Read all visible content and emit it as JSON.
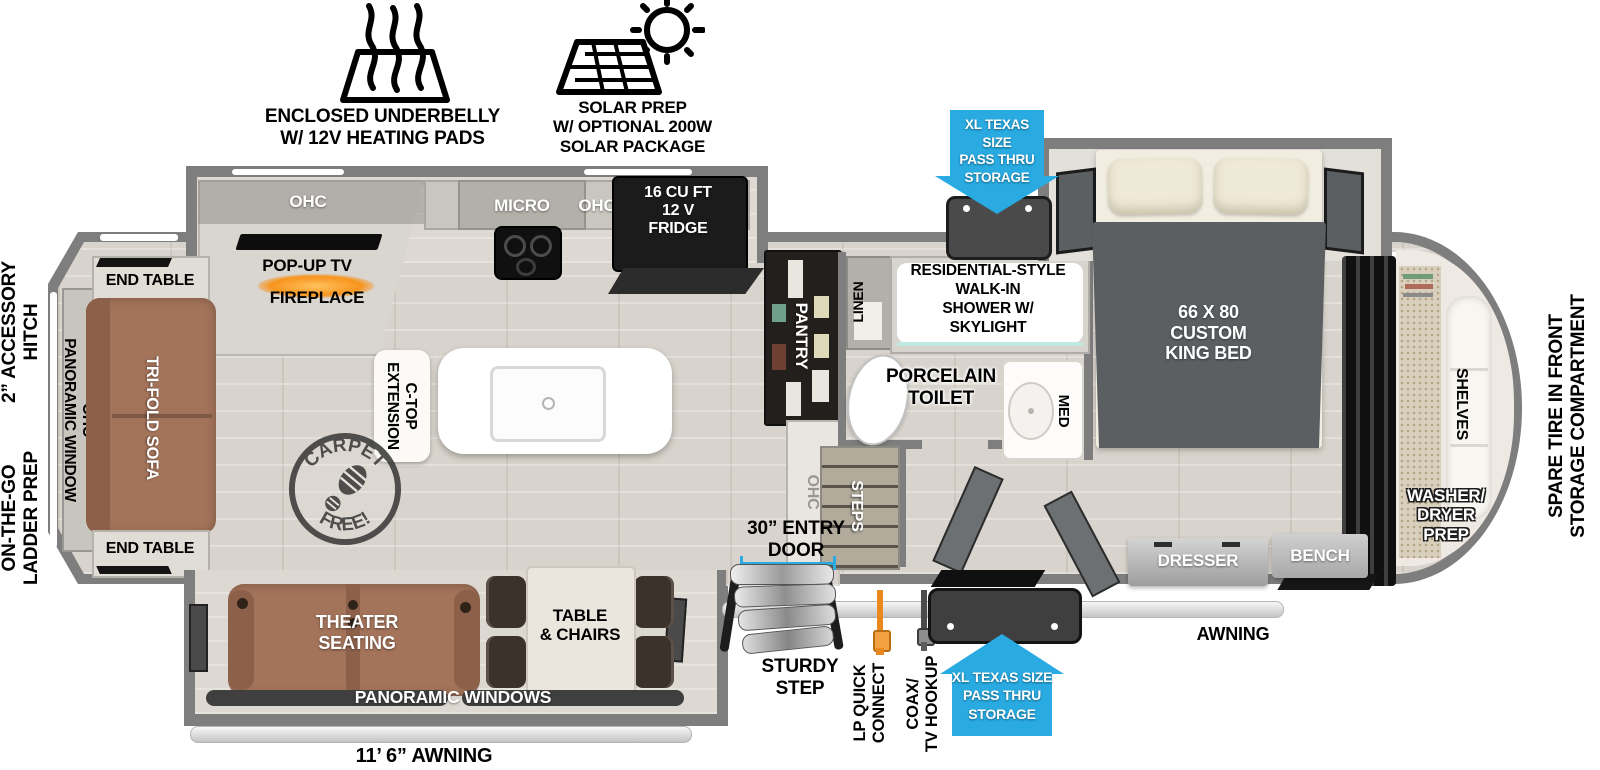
{
  "title": "Fifth-wheel RV floorplan",
  "colors": {
    "accent_blue": "#29ABE2",
    "lp_orange": "#E8881E",
    "fireplace_orange": "#F7941E",
    "sofa_brown": "#A3735A",
    "wall_gray": "#7E7E7E",
    "cabinet_black": "#1B1B1B"
  },
  "features": {
    "underbelly_label": "ENCLOSED UNDERBELLY\nW/ 12V HEATING PADS",
    "solar_label": "SOLAR PREP\nW/ OPTIONAL 200W\nSOLAR PACKAGE"
  },
  "storage": {
    "pass_thru_top": "XL TEXAS SIZE\nPASS THRU\nSTORAGE",
    "pass_thru_bottom": "XL TEXAS SIZE\nPASS THRU\nSTORAGE"
  },
  "exterior": {
    "hitch": "2” ACCESSORY\nHITCH",
    "ladder_prep": "ON-THE-GO\nLADDER PREP",
    "spare_tire": "SPARE TIRE IN FRONT\nSTORAGE COMPARTMENT",
    "awning_main": "11’ 6” AWNING",
    "awning_front": "AWNING",
    "entry_door": "30” ENTRY\nDOOR",
    "sturdy_step": "STURDY\nSTEP",
    "lp_quick_connect": "LP QUICK\nCONNECT",
    "coax_tv_hookup": "COAX/\nTV HOOKUP"
  },
  "living_room": {
    "ohc": "OHC",
    "pop_up_tv": "POP-UP TV",
    "fireplace": "FIREPLACE",
    "end_table_top": "END TABLE",
    "end_table_bottom": "END TABLE",
    "tri_fold_sofa": "TRI-FOLD SOFA",
    "panoramic_window": "OHC\nPANORAMIC WINDOW",
    "carpet_free": {
      "top": "CARPET",
      "bottom": "FREE!"
    },
    "theater_seating": "THEATER\nSEATING",
    "table_chairs": "TABLE\n& CHAIRS",
    "panoramic_windows": "PANORAMIC WINDOWS"
  },
  "kitchen": {
    "micro": "MICRO",
    "ohc": "OHC",
    "fridge": "16 CU FT\n12 V\nFRIDGE",
    "pantry": "PANTRY",
    "pantry_ohc": "OHC",
    "ctop_extension": "C-TOP\nEXTENSION"
  },
  "bathroom": {
    "shower": "RESIDENTIAL-STYLE\nWALK-IN\nSHOWER W/\nSKYLIGHT",
    "linen": "LINEN",
    "toilet": "PORCELAIN\nTOILET",
    "med": "MED",
    "steps": "STEPS"
  },
  "bedroom": {
    "bed": "66 X 80\nCUSTOM\nKING BED",
    "dresser": "DRESSER",
    "bench": "BENCH"
  },
  "front_storage": {
    "shelves": "SHELVES",
    "washer_dryer": "WASHER/\nDRYER\nPREP"
  }
}
